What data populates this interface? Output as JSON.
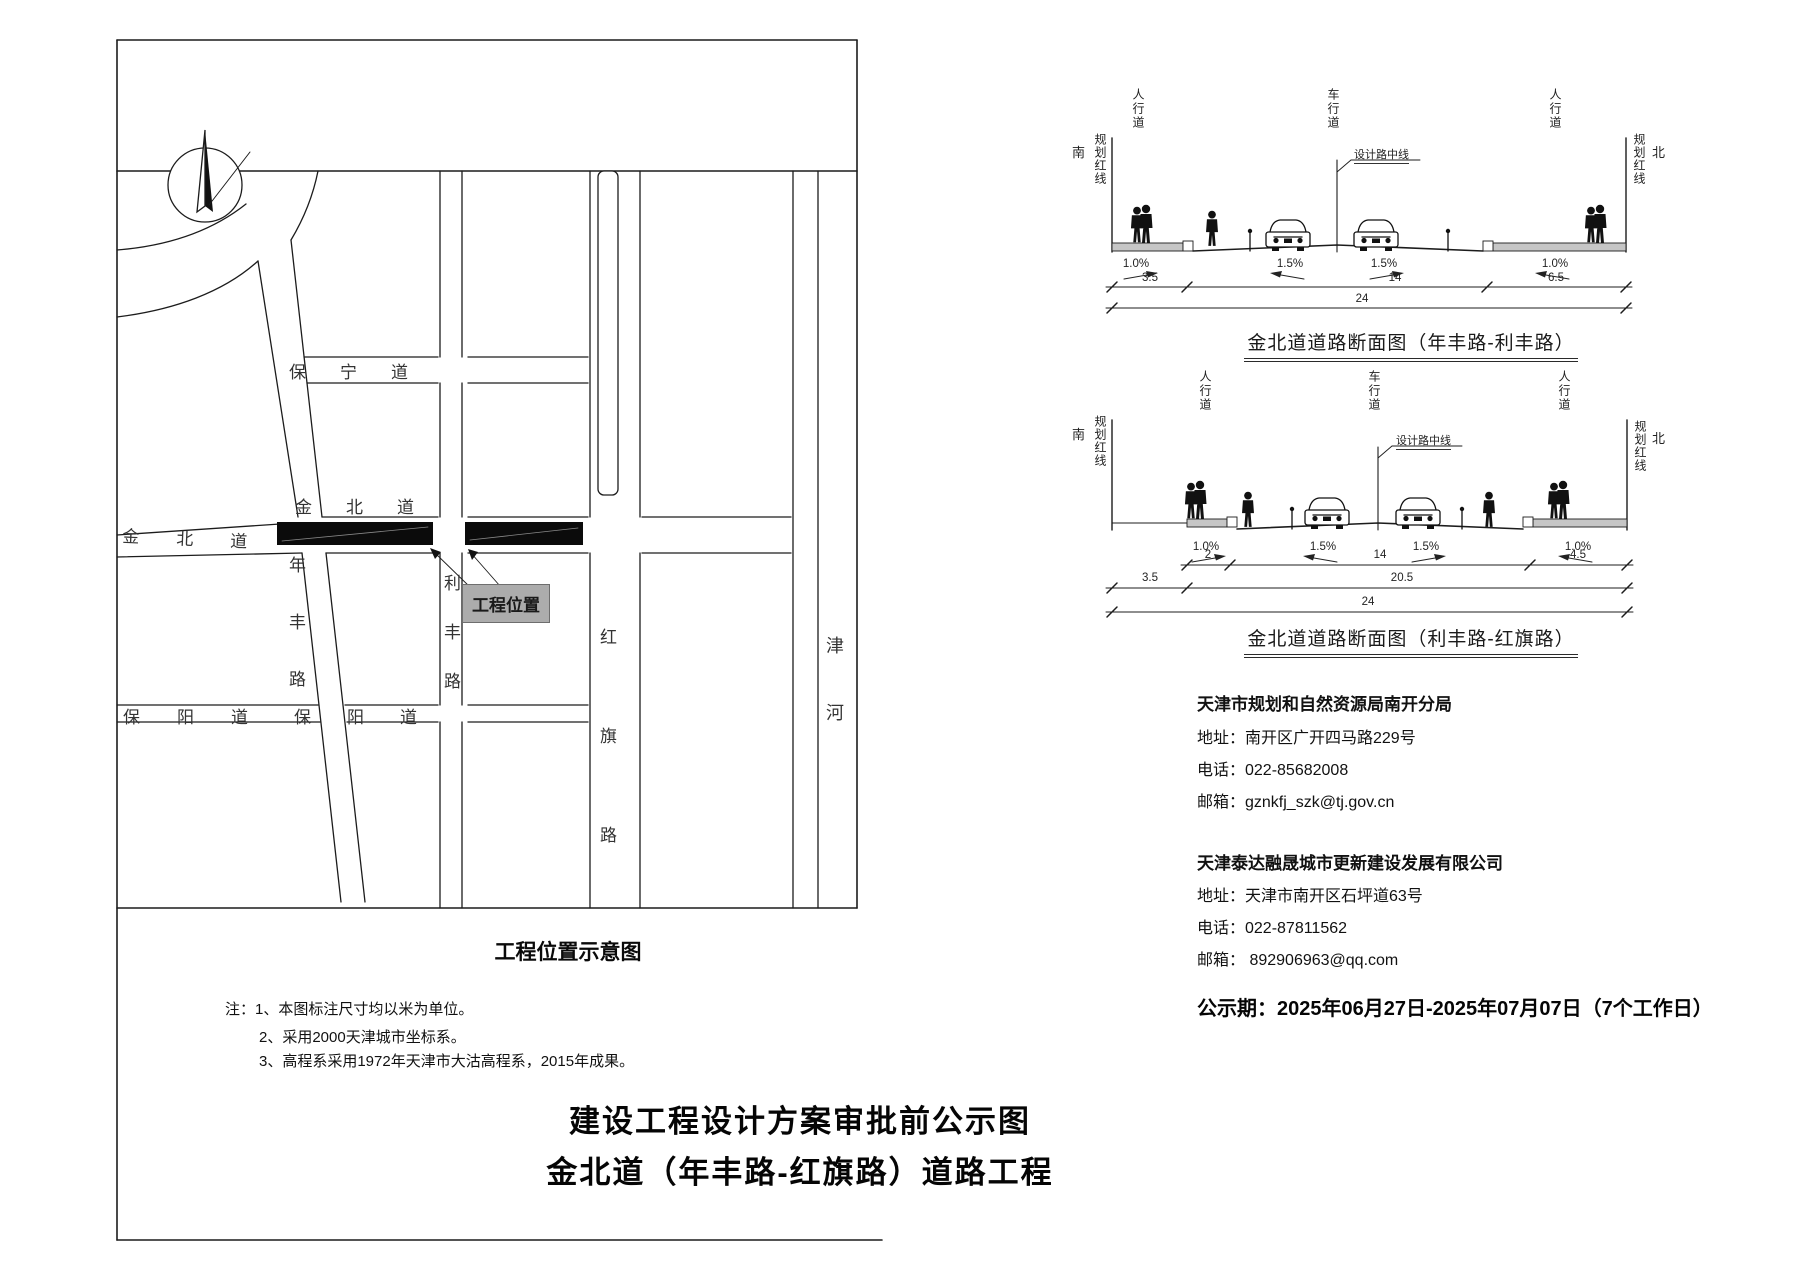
{
  "map": {
    "caption": "工程位置示意图",
    "project_label": "工程位置",
    "road_baoning": "保宁道",
    "road_jinbei": "金北道",
    "road_baoyang": "保阳道",
    "road_nianfeng": "年丰路",
    "road_lifeng": "利丰路",
    "road_hongqi": "红旗路",
    "river_jinhe": "津河"
  },
  "sections": {
    "labels": {
      "sidewalk": "人行道",
      "carriageway": "车行道",
      "south": "南",
      "north": "北",
      "red_line": "规划红线",
      "center_line": "设计路中线"
    },
    "s1": {
      "title": "金北道道路断面图（年丰路-利丰路）",
      "slope_outer": "1.0%",
      "slope_inner": "1.5%",
      "dim_sidewalk_left": "3.5",
      "dim_carriageway": "14",
      "dim_sidewalk_right": "6.5",
      "dim_total": "24"
    },
    "s2": {
      "title": "金北道道路断面图（利丰路-红旗路）",
      "slope_outer": "1.0%",
      "slope_inner": "1.5%",
      "dim_walk": "2",
      "dim_carriageway": "14",
      "dim_sidewalk_right": "4.5",
      "dim_setback": "3.5",
      "dim_inner_total": "20.5",
      "dim_total": "24"
    }
  },
  "contacts": [
    {
      "org": "天津市规划和自然资源局南开分局",
      "address": "地址：南开区广开四马路229号",
      "phone": "电话：022-85682008",
      "email": "邮箱：gznkfj_szk@tj.gov.cn"
    },
    {
      "org": "天津泰达融晟城市更新建设发展有限公司",
      "address": "地址：天津市南开区石坪道63号",
      "phone": "电话：022-87811562",
      "email": "邮箱： 892906963@qq.com"
    }
  ],
  "notice_period": "公示期：2025年06月27日-2025年07月07日（7个工作日）",
  "notes": [
    "注：1、本图标注尺寸均以米为单位。",
    "2、采用2000天津城市坐标系。",
    "3、高程系采用1972年天津市大沽高程系，2015年成果。"
  ],
  "footer_titles": [
    "建设工程设计方案审批前公示图",
    "金北道（年丰路-红旗路）道路工程"
  ]
}
